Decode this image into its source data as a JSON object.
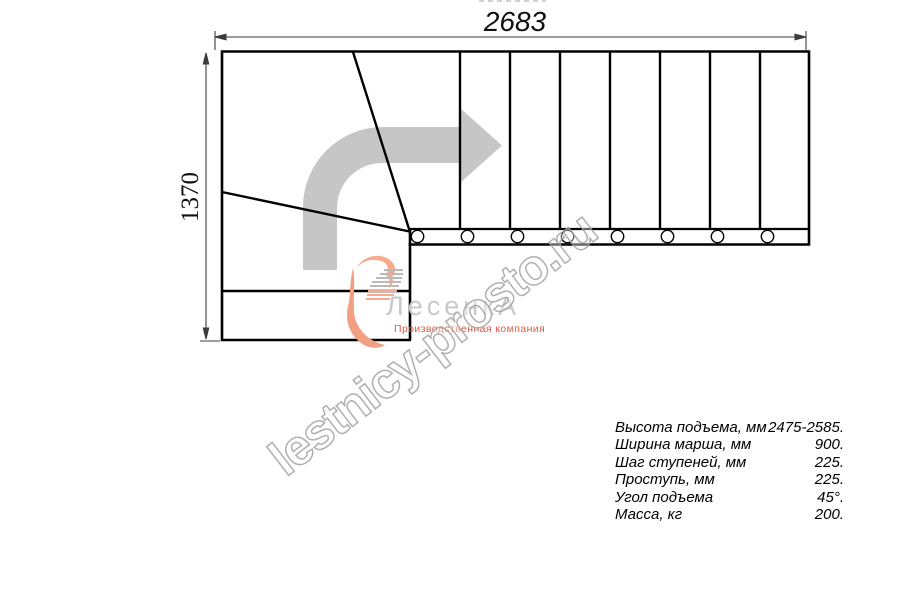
{
  "dimensions": {
    "width_mm": "2683",
    "height_mm": "1370"
  },
  "watermark": {
    "text": "lestnicy-prosto.ru"
  },
  "logo": {
    "name": "ЛесенкА",
    "subtitle": "Производственная компания",
    "swoosh_icon": "logo-swoosh-icon"
  },
  "plan": {
    "direction_arrow_icon": "turn-right-direction-arrow",
    "baluster_count": 8,
    "straight_tread_lines": 7,
    "winder_lines": 2
  },
  "specs": {
    "rows": [
      {
        "label": "Высота подъема, мм",
        "value": "2475-2585."
      },
      {
        "label": "Ширина марша, мм",
        "value": "900."
      },
      {
        "label": "Шаг ступеней, мм",
        "value": "225."
      },
      {
        "label": "Проступь, мм",
        "value": "225."
      },
      {
        "label": "Угол подъема",
        "value": "45°."
      },
      {
        "label": "Масса, кг",
        "value": "200."
      }
    ]
  },
  "colors": {
    "line": "#000000",
    "dimension": "#3c3c3c",
    "arrow_gray": "#c6c6c6",
    "watermark_gray": "#a3a3a3",
    "logo_gray": "#c9c9c9",
    "logo_red": "#e25a41",
    "logo_peach": "#f5ab8e"
  }
}
